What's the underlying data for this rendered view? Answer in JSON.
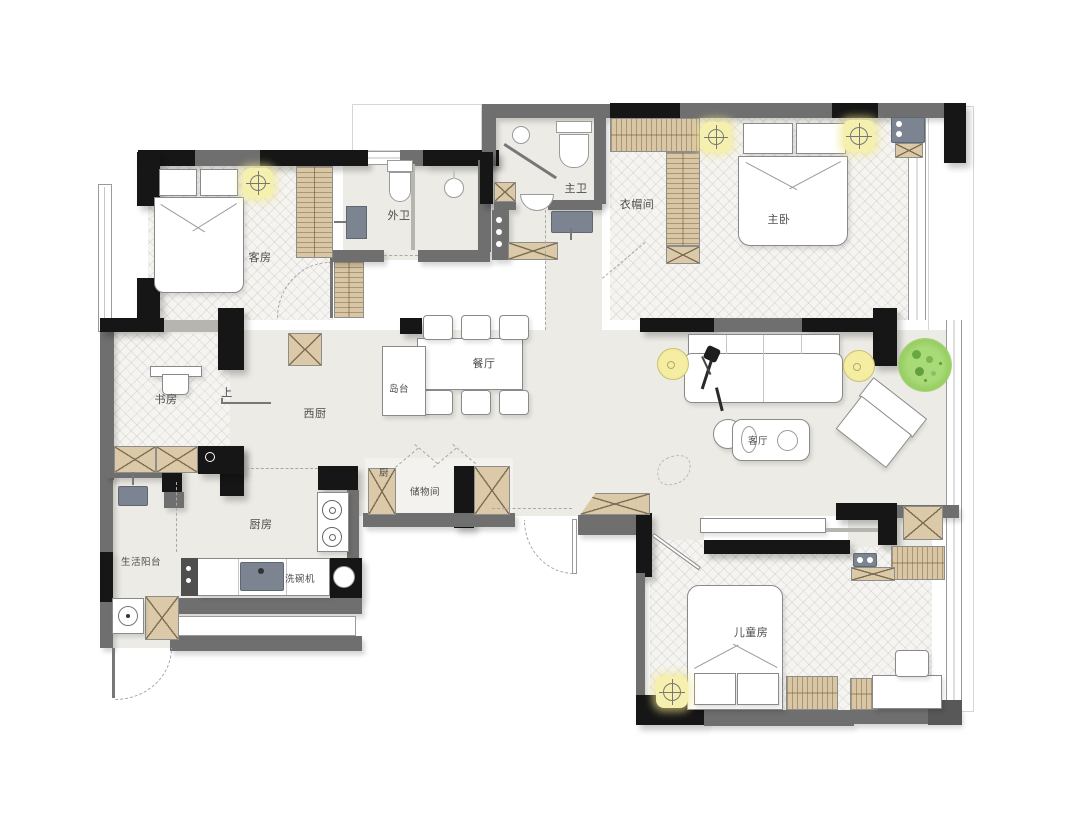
{
  "rooms": [
    {
      "id": "guest-room",
      "label": "客房"
    },
    {
      "id": "guest-bathroom",
      "label": "外卫"
    },
    {
      "id": "master-bathroom",
      "label": "主卫"
    },
    {
      "id": "walk-in-closet",
      "label": "衣帽间"
    },
    {
      "id": "master-bedroom",
      "label": "主卧"
    },
    {
      "id": "dining-room",
      "label": "餐厅"
    },
    {
      "id": "island-counter",
      "label": "岛台"
    },
    {
      "id": "study",
      "label": "书房"
    },
    {
      "id": "step-up",
      "label": "上"
    },
    {
      "id": "west-kitchen",
      "label": "西厨"
    },
    {
      "id": "living-room",
      "label": "客厅"
    },
    {
      "id": "kitchen-cabinet",
      "label": "厨"
    },
    {
      "id": "storage-room",
      "label": "储物间"
    },
    {
      "id": "kitchen",
      "label": "厨房"
    },
    {
      "id": "utility-balcony",
      "label": "生活阳台"
    },
    {
      "id": "dishwasher",
      "label": "洗碗机"
    },
    {
      "id": "kids-room",
      "label": "儿童房"
    }
  ],
  "colors": {
    "wall_structural": "#161616",
    "wall_partition": "#6f6f6f",
    "floor": "#edebe5",
    "cabinet_wood": "#dbc9a8",
    "light_fixture": "#f6f0ae",
    "plant_green": "#97ce62",
    "fixture_gray": "#7b8490"
  }
}
